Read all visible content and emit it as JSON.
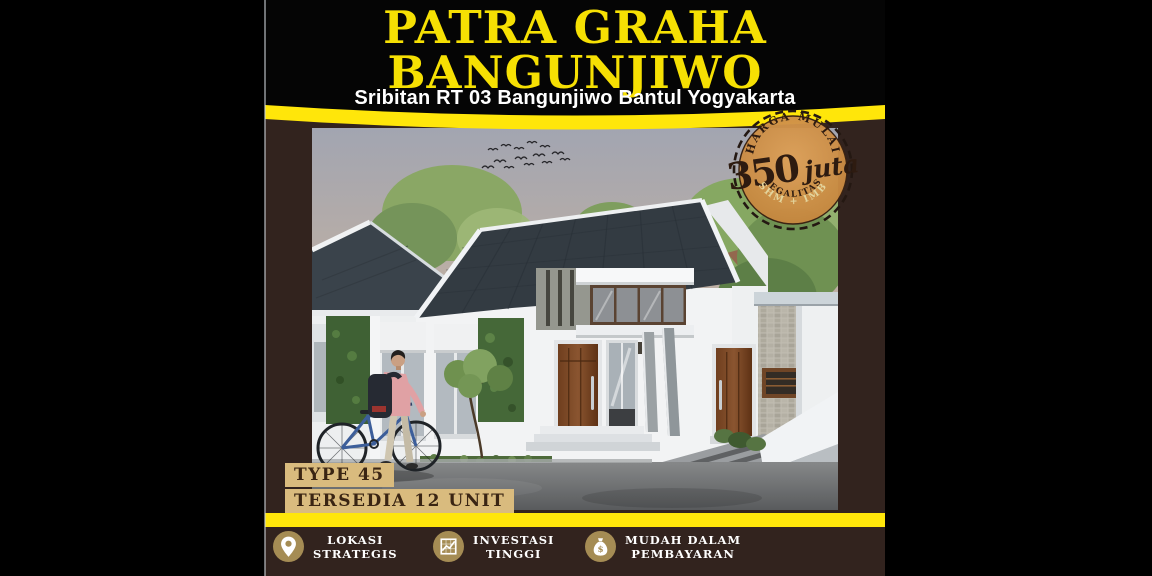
{
  "header": {
    "title_line1": "PATRA GRAHA",
    "title_line2": "BANGUNJIWO",
    "subtitle": "Sribitan RT 03 Bangunjiwo Bantul Yogyakarta"
  },
  "price_badge": {
    "heading": "HARGA MULAI",
    "amount": "350",
    "unit": "juta",
    "legality_label": "LEGALITAS",
    "legality_value": "SHM + IMB"
  },
  "unit_info": {
    "type": "TYPE 45",
    "availability": "TERSEDIA 12 UNIT"
  },
  "features": [
    {
      "icon": "location-pin-icon",
      "line1": "LOKASI",
      "line2": "STRATEGIS"
    },
    {
      "icon": "investment-chart-icon",
      "line1": "INVESTASI",
      "line2": "TINGGI"
    },
    {
      "icon": "money-bag-icon",
      "line1": "MUDAH DALAM",
      "line2": "PEMBAYARAN"
    }
  ],
  "colors": {
    "accent_yellow": "#ffe60a",
    "title_yellow": "#f6e003",
    "flyer_background": "#32231e",
    "badge_orange": "#cc8f45",
    "label_tan": "#d9bb7e",
    "feature_gold": "#a58c54"
  }
}
